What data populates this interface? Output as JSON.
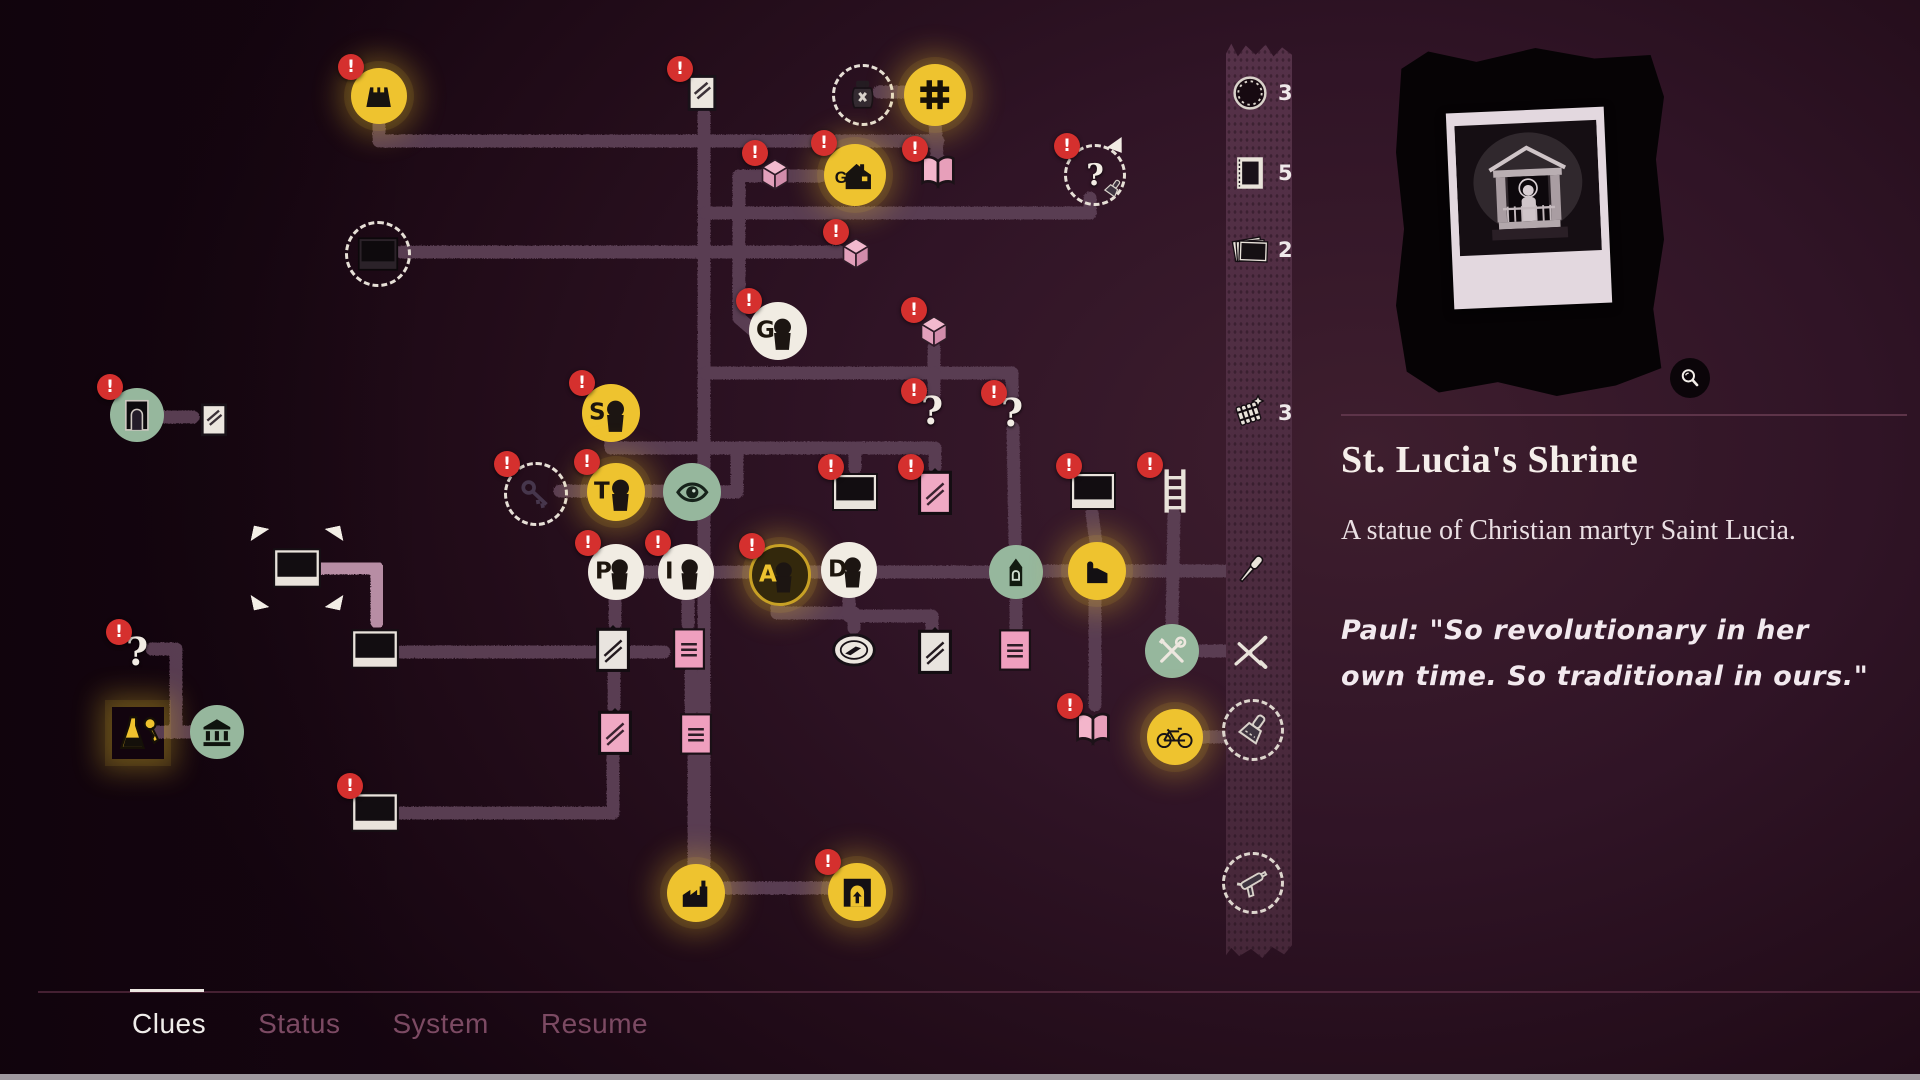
{
  "tabs": {
    "items": [
      {
        "label": "Clues",
        "active": true
      },
      {
        "label": "Status",
        "active": false
      },
      {
        "label": "System",
        "active": false
      },
      {
        "label": "Resume",
        "active": false
      }
    ]
  },
  "panel": {
    "title": "St. Lucia's Shrine",
    "description": "A statue of Christian martyr Saint Lucia.",
    "quote": "Paul: \"So revolutionary in her own time. So traditional in ours.\""
  },
  "sidebar": {
    "items": [
      {
        "id": "bottle-caps",
        "icon": "bottlecap",
        "y": 93,
        "count": "3"
      },
      {
        "id": "matchbox",
        "icon": "matchbox",
        "y": 173,
        "count": "5"
      },
      {
        "id": "photo-stack",
        "icon": "photostack",
        "y": 250,
        "count": "2"
      },
      {
        "id": "firecrackers",
        "icon": "firecrackers",
        "y": 413,
        "count": "3"
      },
      {
        "id": "screwdriver",
        "icon": "screwdriver",
        "y": 570
      },
      {
        "id": "pliers",
        "icon": "pliers",
        "y": 650
      },
      {
        "id": "scraper",
        "icon": "scraper",
        "y": 727,
        "dashed": true
      },
      {
        "id": "unknown-tool",
        "icon": "caulkgun",
        "y": 880,
        "dashed": true
      }
    ]
  },
  "graph": {
    "badge_text": "!",
    "edge_color": "#5b3f55",
    "edge_highlight": "#b78da4",
    "accent_yellow": "#eec32f",
    "accent_green": "#96b79d",
    "accent_pink": "#f2b9ce",
    "badge_red": "#d5302e",
    "nodes": [
      {
        "id": "castle",
        "icon": "castle",
        "shape": "yellow",
        "x": 379,
        "y": 96,
        "s": 56,
        "badge": true,
        "glow": true
      },
      {
        "id": "note-1",
        "icon": "note",
        "shape": "plain",
        "x": 702,
        "y": 92,
        "s": 44,
        "badge": true
      },
      {
        "id": "jar",
        "icon": "jar",
        "shape": "dashed",
        "x": 860,
        "y": 92,
        "s": 56
      },
      {
        "id": "grid-cross",
        "icon": "hash",
        "shape": "yellow",
        "x": 935,
        "y": 95,
        "s": 62,
        "glow": true
      },
      {
        "id": "cube-1",
        "icon": "cube",
        "shape": "plain",
        "x": 775,
        "y": 174,
        "s": 40,
        "badge": true
      },
      {
        "id": "house-g",
        "icon": "house",
        "shape": "yellow",
        "x": 855,
        "y": 175,
        "s": 62,
        "badge": true,
        "glow": true
      },
      {
        "id": "book-1",
        "icon": "book",
        "shape": "plain",
        "x": 938,
        "y": 173,
        "s": 46,
        "badge": true
      },
      {
        "id": "unknown-brush",
        "icon": "brushq",
        "shape": "dashed",
        "x": 1092,
        "y": 172,
        "s": 56,
        "badge": true
      },
      {
        "id": "photo-hidden",
        "icon": "polaroid-dark",
        "shape": "dashed",
        "x": 375,
        "y": 251,
        "s": 60
      },
      {
        "id": "cube-2",
        "icon": "cube",
        "shape": "plain",
        "x": 856,
        "y": 253,
        "s": 40,
        "badge": true
      },
      {
        "id": "person-g",
        "icon": "head",
        "letter": "G",
        "shape": "white",
        "x": 778,
        "y": 331,
        "s": 58,
        "badge": true
      },
      {
        "id": "cube-3",
        "icon": "cube",
        "shape": "plain",
        "x": 934,
        "y": 331,
        "s": 40,
        "badge": true
      },
      {
        "id": "arch-door",
        "icon": "arch",
        "shape": "green",
        "x": 137,
        "y": 415,
        "s": 54,
        "badge": true
      },
      {
        "id": "note-2",
        "icon": "note",
        "shape": "plain",
        "x": 214,
        "y": 419,
        "s": 40
      },
      {
        "id": "person-s",
        "icon": "head",
        "letter": "S",
        "shape": "yellow",
        "x": 611,
        "y": 413,
        "s": 58,
        "badge": true
      },
      {
        "id": "key",
        "icon": "key",
        "shape": "dashed",
        "x": 533,
        "y": 491,
        "s": 58,
        "badge": true
      },
      {
        "id": "person-t",
        "icon": "head",
        "letter": "T",
        "shape": "yellow",
        "x": 616,
        "y": 492,
        "s": 58,
        "badge": true,
        "glow": true
      },
      {
        "id": "eye",
        "icon": "eye",
        "shape": "green",
        "x": 692,
        "y": 492,
        "s": 58
      },
      {
        "id": "photo-center",
        "icon": "polaroid",
        "shape": "plain",
        "x": 855,
        "y": 492,
        "s": 48,
        "badge": true
      },
      {
        "id": "clip-pink-1",
        "icon": "clip-pink",
        "shape": "plain",
        "x": 935,
        "y": 492,
        "s": 48,
        "badge": true
      },
      {
        "id": "question-1",
        "icon": "question",
        "shape": "plain",
        "x": 932,
        "y": 410,
        "s": 36,
        "badge": true
      },
      {
        "id": "question-2",
        "icon": "question",
        "shape": "plain",
        "x": 1012,
        "y": 412,
        "s": 36,
        "badge": true
      },
      {
        "id": "photo-white",
        "icon": "polaroid",
        "shape": "plain",
        "x": 1093,
        "y": 491,
        "s": 48,
        "badge": true
      },
      {
        "id": "ladder",
        "icon": "ladder",
        "shape": "plain",
        "x": 1175,
        "y": 491,
        "s": 50,
        "badge": true
      },
      {
        "id": "person-p",
        "icon": "head",
        "letter": "P",
        "shape": "white",
        "x": 616,
        "y": 572,
        "s": 56,
        "badge": true
      },
      {
        "id": "person-i",
        "icon": "head",
        "letter": "I",
        "shape": "white",
        "x": 686,
        "y": 572,
        "s": 56,
        "badge": true
      },
      {
        "id": "person-a",
        "icon": "head",
        "letter": "A",
        "shape": "dark",
        "x": 777,
        "y": 572,
        "s": 56,
        "badge": true,
        "glow": true
      },
      {
        "id": "person-d",
        "icon": "head",
        "letter": "D",
        "shape": "white",
        "x": 849,
        "y": 570,
        "s": 56
      },
      {
        "id": "church",
        "icon": "church",
        "shape": "green",
        "x": 1016,
        "y": 572,
        "s": 54
      },
      {
        "id": "building-b",
        "icon": "bfactory",
        "shape": "yellow",
        "x": 1097,
        "y": 571,
        "s": 58,
        "glow": true
      },
      {
        "id": "shrine-photo",
        "icon": "polaroid",
        "shape": "plain",
        "x": 297,
        "y": 568,
        "s": 50,
        "selected": true
      },
      {
        "id": "photo-2",
        "icon": "polaroid",
        "shape": "plain",
        "x": 375,
        "y": 649,
        "s": 50
      },
      {
        "id": "clip-white-1",
        "icon": "clip-white",
        "shape": "plain",
        "x": 613,
        "y": 649,
        "s": 48
      },
      {
        "id": "paper-1",
        "icon": "paper",
        "shape": "plain",
        "x": 689,
        "y": 649,
        "s": 44
      },
      {
        "id": "compass",
        "icon": "compass",
        "shape": "plain",
        "x": 854,
        "y": 650,
        "s": 46
      },
      {
        "id": "clip-white-2",
        "icon": "clip-white",
        "shape": "plain",
        "x": 935,
        "y": 651,
        "s": 48
      },
      {
        "id": "paper-3",
        "icon": "paper",
        "shape": "plain",
        "x": 1015,
        "y": 650,
        "s": 44
      },
      {
        "id": "tools",
        "icon": "tools",
        "shape": "green",
        "x": 1172,
        "y": 651,
        "s": 54
      },
      {
        "id": "clip-pink-2",
        "icon": "clip-pink",
        "shape": "plain",
        "x": 615,
        "y": 732,
        "s": 48
      },
      {
        "id": "paper-2",
        "icon": "paper",
        "shape": "plain",
        "x": 696,
        "y": 734,
        "s": 44
      },
      {
        "id": "book-2",
        "icon": "book",
        "shape": "plain",
        "x": 1093,
        "y": 730,
        "s": 46,
        "badge": true
      },
      {
        "id": "bike",
        "icon": "bike",
        "shape": "yellow",
        "x": 1175,
        "y": 737,
        "s": 56,
        "glow": true
      },
      {
        "id": "question-3",
        "icon": "question",
        "shape": "plain",
        "x": 137,
        "y": 651,
        "s": 36,
        "badge": true
      },
      {
        "id": "flask-keys",
        "icon": "flaskkeys",
        "shape": "plain",
        "x": 138,
        "y": 733,
        "s": 52,
        "glow": true
      },
      {
        "id": "bank",
        "icon": "bank",
        "shape": "green",
        "x": 217,
        "y": 732,
        "s": 54
      },
      {
        "id": "photo-3",
        "icon": "polaroid",
        "shape": "plain",
        "x": 375,
        "y": 812,
        "s": 50,
        "badge": true
      },
      {
        "id": "factory",
        "icon": "factory",
        "shape": "yellow",
        "x": 696,
        "y": 893,
        "s": 58,
        "glow": true
      },
      {
        "id": "doorway",
        "icon": "doorway",
        "shape": "yellow",
        "x": 857,
        "y": 892,
        "s": 58,
        "badge": true,
        "glow": true
      }
    ],
    "edges": [
      {
        "p": [
          [
            379,
            124
          ],
          [
            379,
            141
          ],
          [
            938,
            141
          ]
        ]
      },
      {
        "p": [
          [
            704,
            114
          ],
          [
            704,
            888
          ],
          [
            828,
            888
          ]
        ]
      },
      {
        "p": [
          [
            879,
            92
          ],
          [
            904,
            92
          ]
        ]
      },
      {
        "p": [
          [
            935,
            122
          ],
          [
            937,
            156
          ]
        ]
      },
      {
        "p": [
          [
            706,
            213
          ],
          [
            1090,
            213
          ],
          [
            1090,
            198
          ]
        ]
      },
      {
        "p": [
          [
            402,
            252
          ],
          [
            840,
            252
          ]
        ]
      },
      {
        "p": [
          [
            739,
            176
          ],
          [
            739,
            318
          ],
          [
            754,
            331
          ]
        ]
      },
      {
        "p": [
          [
            739,
            176
          ],
          [
            820,
            176
          ]
        ]
      },
      {
        "p": [
          [
            934,
            348
          ],
          [
            934,
            372
          ]
        ]
      },
      {
        "p": [
          [
            706,
            373
          ],
          [
            1012,
            373
          ],
          [
            1012,
            395
          ]
        ]
      },
      {
        "p": [
          [
            934,
            373
          ],
          [
            934,
            394
          ]
        ]
      },
      {
        "p": [
          [
            1013,
            428
          ],
          [
            1015,
            544
          ]
        ]
      },
      {
        "p": [
          [
            163,
            417
          ],
          [
            193,
            417
          ]
        ]
      },
      {
        "p": [
          [
            611,
            440
          ],
          [
            611,
            448
          ],
          [
            935,
            448
          ],
          [
            935,
            467
          ]
        ]
      },
      {
        "p": [
          [
            855,
            448
          ],
          [
            855,
            468
          ]
        ]
      },
      {
        "p": [
          [
            737,
            448
          ],
          [
            737,
            492
          ],
          [
            722,
            492
          ]
        ]
      },
      {
        "p": [
          [
            560,
            491
          ],
          [
            586,
            491
          ]
        ]
      },
      {
        "p": [
          [
            646,
            491
          ],
          [
            662,
            491
          ]
        ]
      },
      {
        "p": [
          [
            640,
            572
          ],
          [
            990,
            572
          ]
        ]
      },
      {
        "p": [
          [
            1044,
            571
          ],
          [
            1068,
            571
          ]
        ]
      },
      {
        "p": [
          [
            1125,
            571
          ],
          [
            1238,
            571
          ]
        ]
      },
      {
        "p": [
          [
            777,
            600
          ],
          [
            777,
            613
          ],
          [
            854,
            613
          ],
          [
            854,
            628
          ]
        ]
      },
      {
        "p": [
          [
            615,
            600
          ],
          [
            615,
            624
          ]
        ]
      },
      {
        "p": [
          [
            688,
            600
          ],
          [
            688,
            624
          ]
        ]
      },
      {
        "p": [
          [
            614,
            674
          ],
          [
            614,
            707
          ]
        ]
      },
      {
        "p": [
          [
            691,
            672
          ],
          [
            691,
            711
          ]
        ]
      },
      {
        "p": [
          [
            694,
            758
          ],
          [
            694,
            870
          ]
        ]
      },
      {
        "p": [
          [
            401,
            652
          ],
          [
            664,
            652
          ]
        ]
      },
      {
        "p": [
          [
            321,
            568
          ],
          [
            377,
            568
          ],
          [
            377,
            622
          ]
        ],
        "light": true
      },
      {
        "p": [
          [
            1095,
            600
          ],
          [
            1095,
            705
          ]
        ]
      },
      {
        "p": [
          [
            1201,
            737
          ],
          [
            1224,
            737
          ]
        ]
      },
      {
        "p": [
          [
            152,
            649
          ],
          [
            176,
            649
          ],
          [
            176,
            728
          ]
        ]
      },
      {
        "p": [
          [
            158,
            732
          ],
          [
            192,
            732
          ]
        ]
      },
      {
        "p": [
          [
            399,
            813
          ],
          [
            613,
            813
          ],
          [
            613,
            757
          ]
        ]
      },
      {
        "p": [
          [
            1092,
            513
          ],
          [
            1096,
            543
          ]
        ]
      },
      {
        "p": [
          [
            1174,
            514
          ],
          [
            1172,
            625
          ]
        ]
      },
      {
        "p": [
          [
            849,
            597
          ],
          [
            849,
            616
          ],
          [
            932,
            616
          ],
          [
            932,
            628
          ]
        ]
      },
      {
        "p": [
          [
            1016,
            598
          ],
          [
            1016,
            629
          ]
        ]
      },
      {
        "p": [
          [
            1201,
            651
          ],
          [
            1232,
            651
          ]
        ]
      }
    ]
  }
}
